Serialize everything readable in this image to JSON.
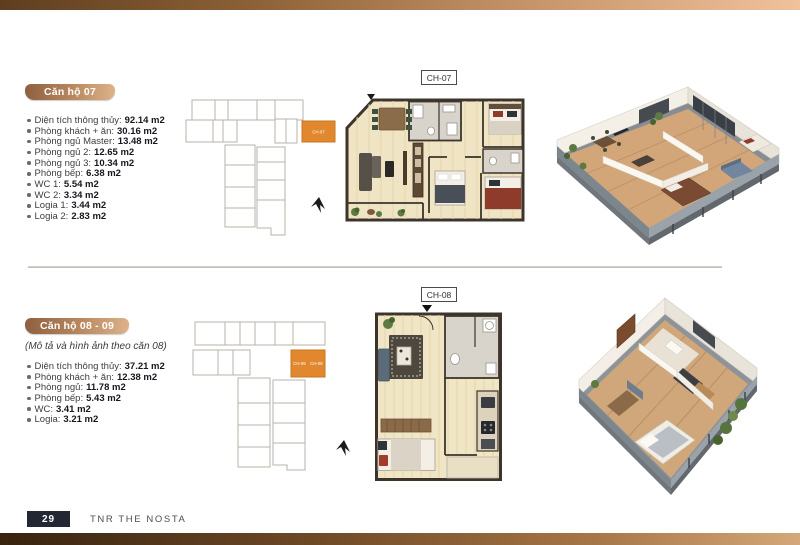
{
  "page_footer": {
    "page_number": "29",
    "brand": "TNR THE NOSTA"
  },
  "unit07": {
    "badge": "Căn hộ 07",
    "plan_label": "CH-07",
    "keyplan_unit_label": "CH-07",
    "specs": [
      {
        "label": "Diện tích thông thủy:",
        "value": "92.14 m2"
      },
      {
        "label": "Phòng khách + ăn:",
        "value": "30.16 m2"
      },
      {
        "label": "Phòng ngủ Master:",
        "value": "13.48 m2"
      },
      {
        "label": "Phòng ngủ 2:",
        "value": "12.65 m2"
      },
      {
        "label": "Phòng ngủ 3:",
        "value": "10.34 m2"
      },
      {
        "label": "Phòng bếp:",
        "value": "6.38 m2"
      },
      {
        "label": "WC 1:",
        "value": "5.54 m2"
      },
      {
        "label": "WC 2:",
        "value": "3.34 m2"
      },
      {
        "label": "Logia 1:",
        "value": "3.44 m2"
      },
      {
        "label": "Logia 2:",
        "value": "2.83 m2"
      }
    ]
  },
  "unit0809": {
    "badge": "Căn hộ 08 - 09",
    "note": "(Mô tả và hình ảnh theo căn 08)",
    "plan_label": "CH-08",
    "keyplan_unit_labels": [
      "CH-09",
      "CH-08"
    ],
    "specs": [
      {
        "label": "Diện tích thông thủy:",
        "value": "37.21 m2"
      },
      {
        "label": "Phòng khách + ăn:",
        "value": "12.38 m2"
      },
      {
        "label": "Phòng ngủ:",
        "value": "11.78 m2"
      },
      {
        "label": "Phòng bếp:",
        "value": "5.43 m2"
      },
      {
        "label": "WC:",
        "value": "3.41 m2"
      },
      {
        "label": "Logia:",
        "value": "3.21 m2"
      }
    ]
  },
  "colors": {
    "highlight_orange": "#E1882F",
    "badge_copper": "#A06B45",
    "footer_navy": "#232733",
    "accent_bar_brown": "#6F4A26",
    "floorplan_floor": "#EFE4C4",
    "wall_dark": "#3D352B"
  },
  "icons": {
    "north_arrow": "north-arrow-icon"
  }
}
